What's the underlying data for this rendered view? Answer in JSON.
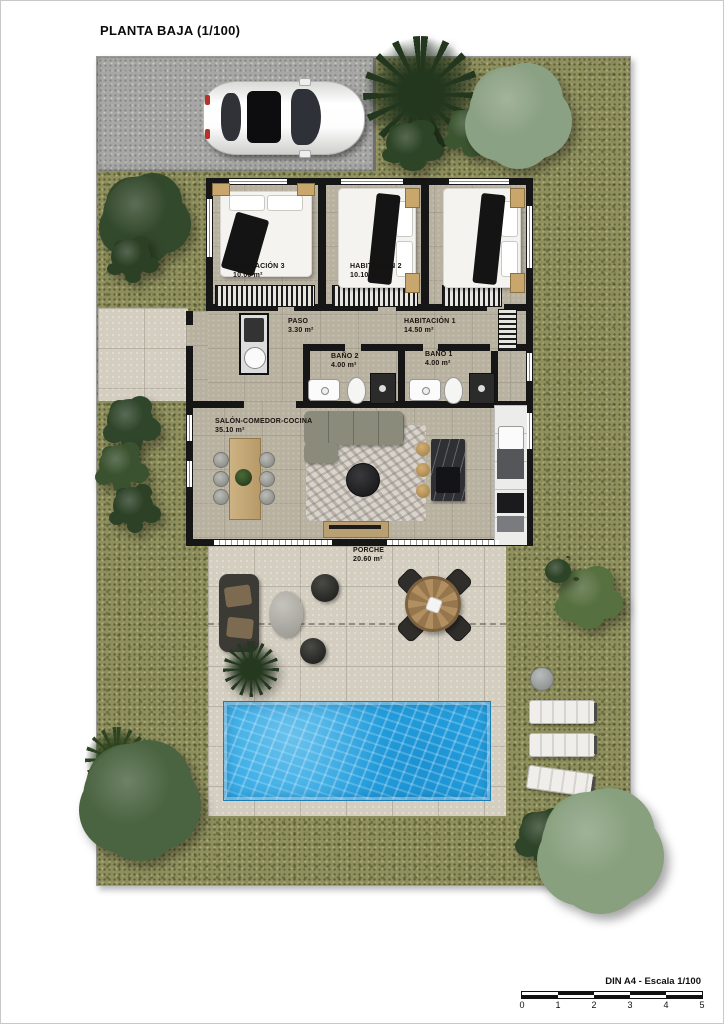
{
  "title": "PLANTA BAJA (1/100)",
  "rooms": {
    "habitacion3": {
      "name": "HABITACIÓN 3",
      "area": "10.00 m²"
    },
    "habitacion2": {
      "name": "HABITACIÓN 2",
      "area": "10.10 m²"
    },
    "habitacion1": {
      "name": "HABITACIÓN 1",
      "area": "14.50 m²"
    },
    "paso": {
      "name": "PASO",
      "area": "3.30 m²"
    },
    "bano2": {
      "name": "BAÑO 2",
      "area": "4.00 m²"
    },
    "bano1": {
      "name": "BAÑO 1",
      "area": "4.00 m²"
    },
    "salon": {
      "name": "SALÓN-COMEDOR-COCINA",
      "area": "35.10 m²"
    },
    "porche": {
      "name": "PORCHE",
      "area": "20.60 m²"
    }
  },
  "scalebar": {
    "label": "DIN A4 - Escala 1/100",
    "ticks": [
      "0",
      "1",
      "2",
      "3",
      "4",
      "5"
    ]
  },
  "colors": {
    "grass": "#90905F",
    "pool_water": "#2BA6E3",
    "floor": "#B8B1A0",
    "wall": "#161616",
    "paving": "#D4CEC1",
    "driveway": "#A7A7A5"
  }
}
